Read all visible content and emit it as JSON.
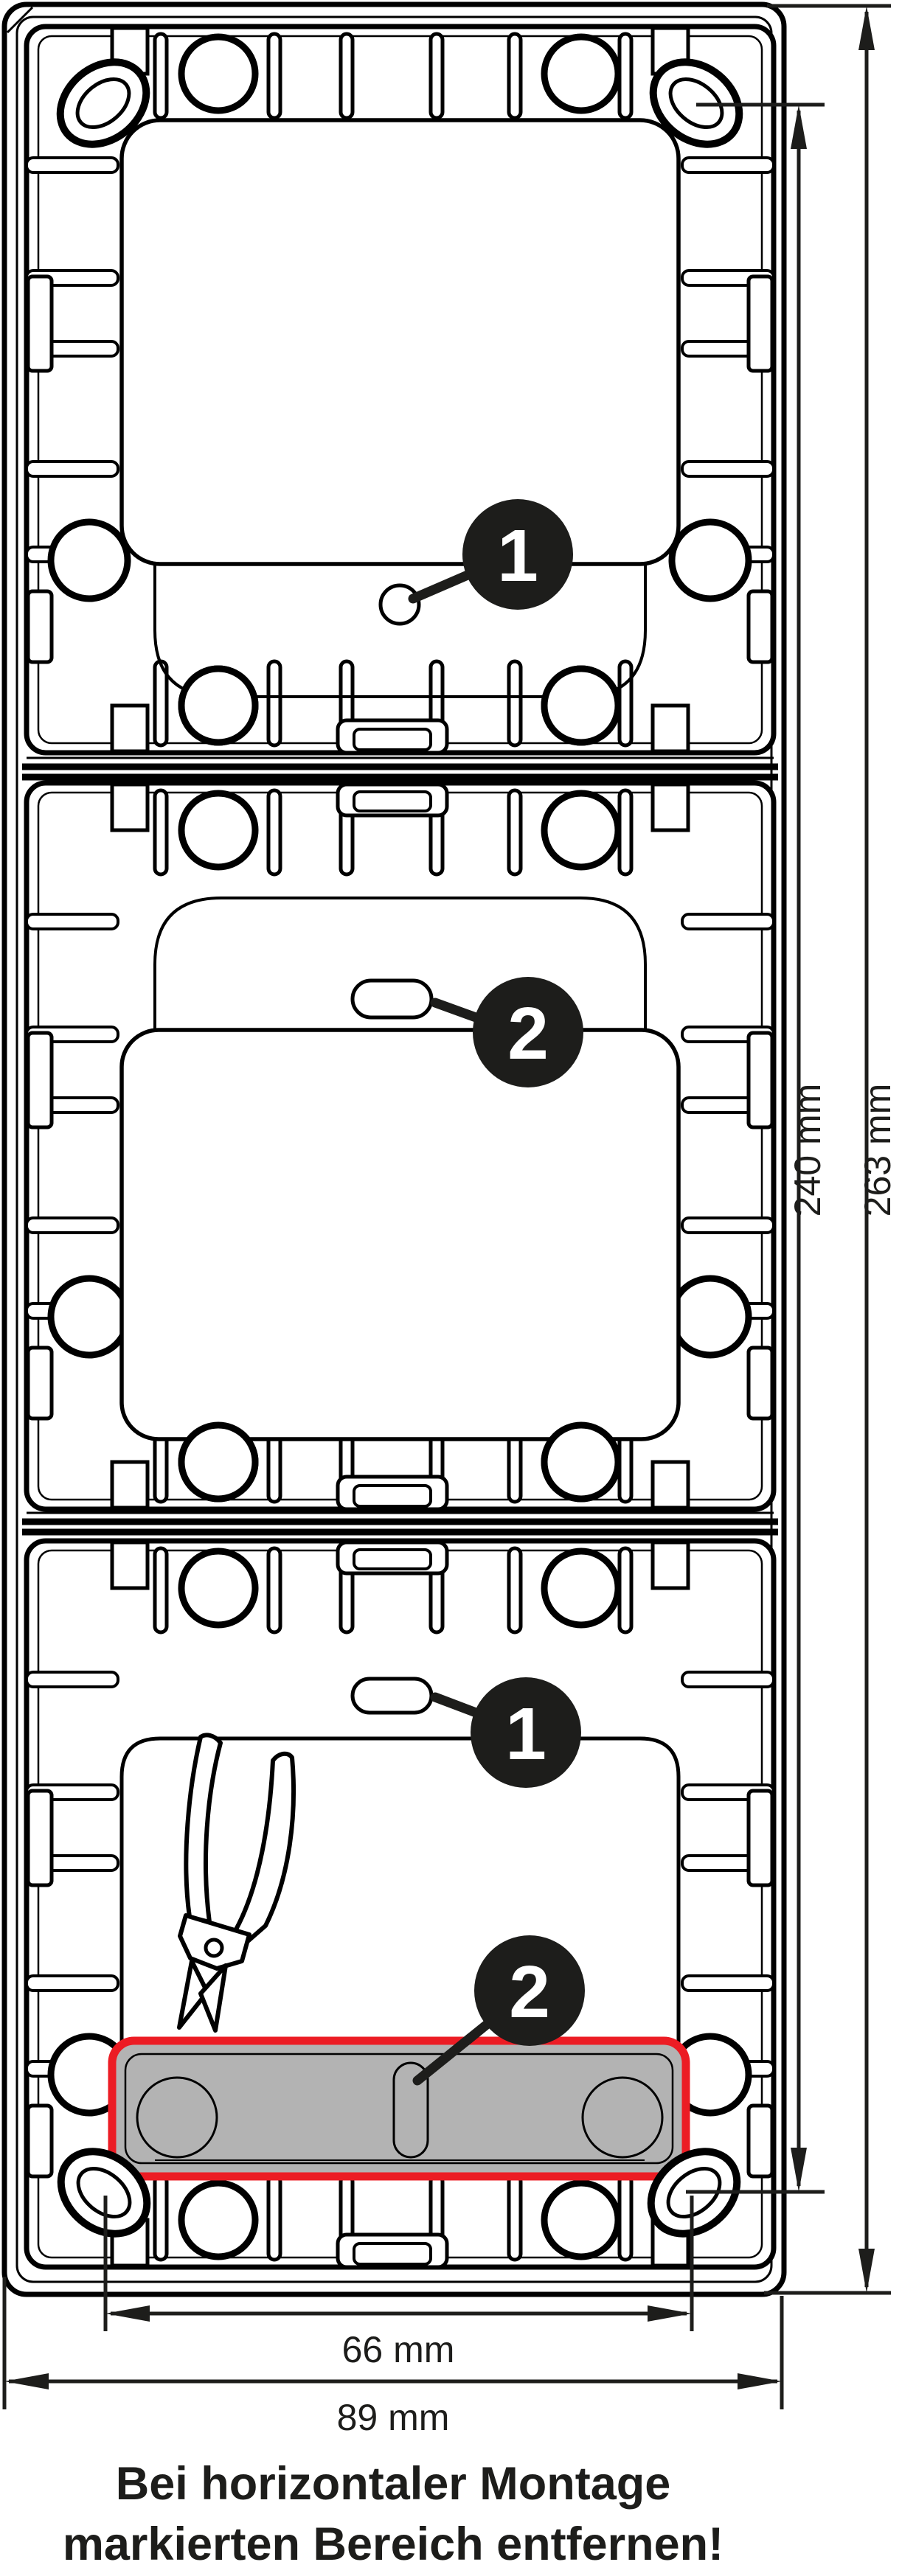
{
  "diagram": {
    "type": "technical-installation-drawing",
    "subject": "3-gang surface mounting frame, rear view",
    "colors": {
      "line": "#000000",
      "badge_fill": "#1d1d1b",
      "badge_text": "#ffffff",
      "marked_area_fill": "#b3b3b3",
      "marked_area_border": "#ec1c24"
    },
    "badges": {
      "top_hole": "1",
      "middle_slot": "2",
      "bottom_slot": "1",
      "bottom_breakout": "2"
    },
    "dimensions": {
      "inner_height": "240 mm",
      "outer_height": "263 mm",
      "inner_width": "66 mm",
      "outer_width": "89 mm"
    },
    "caption": {
      "line1": "Bei horizontaler Montage",
      "line2": "markierten Bereich entfernen!"
    },
    "icons": {
      "tool": "side-cutter-pliers-icon"
    }
  }
}
